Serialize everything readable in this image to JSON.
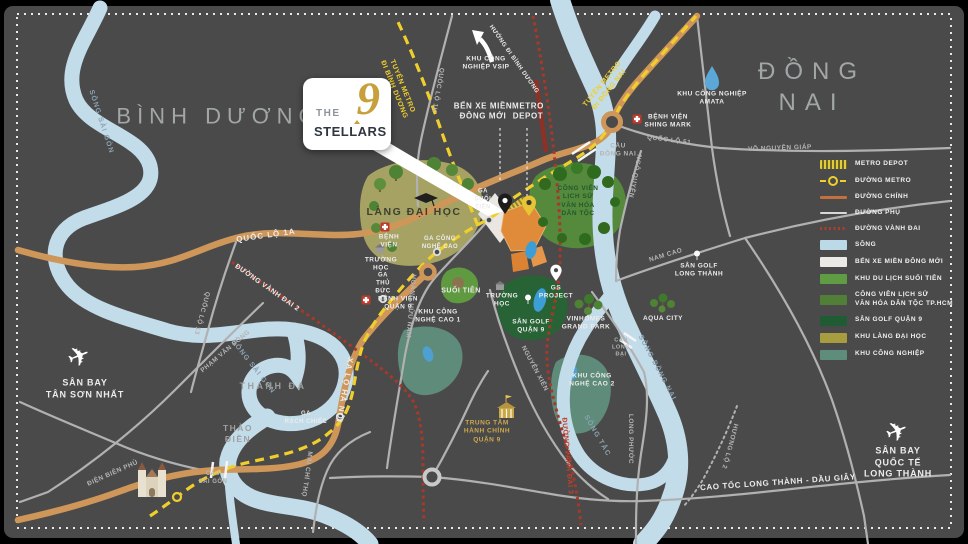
{
  "logo": {
    "the": "THE",
    "nine": "9",
    "name": "STELLARS"
  },
  "colors": {
    "background": "#4a4a4a",
    "river": "#c3dcea",
    "road_main": "#cf9659",
    "road_minor": "#b1b1b1",
    "metro": "#f0cf2c",
    "ring_road": "#a83828",
    "project": "#e08b3a",
    "gold": "#c7a03c"
  },
  "labels": {
    "binh_duong": "BÌNH DƯƠNG",
    "dong_nai": "ĐỒNG NAI",
    "song_sai_gon_a": "SÔNG SÀI GÒN",
    "song_sai_gon_b": "SÔNG SÀI GÒN",
    "song_dong_nai": "SÔNG ĐỒNG NAI",
    "song_tac": "SÔNG TẮC",
    "khu_cn_vsip": "KHU CÔNG\nNGHIỆP VSIP",
    "huong_di_binh_duong": "HƯỚNG ĐI BÌNH DƯƠNG",
    "tuyen_metro_binh_duong": "TUYẾN METRO\nĐI BÌNH DƯƠNG",
    "tuyen_metro_dong_nai": "TUYẾN METRO\nĐI ĐỒNG NAI",
    "quoc_lo_1k": "QUỐC LỘ 1K",
    "ben_xe_mien_dong_moi": "BẾN XE MIỀN\nĐÔNG MỚI",
    "metro_depot_map": "METRO\nDEPOT",
    "cau_dong_nai": "CẦU\nĐỒNG NAI",
    "benh_vien_shing_mark": "BỆNH VIỆN\nSHING MARK",
    "khu_cn_amata": "KHU CÔNG NGHIỆP\nAMATA",
    "quoc_lo_51": "QUỐC LỘ 51",
    "vo_nguyen_giap": "VÕ NGUYÊN GIÁP",
    "ngo_quyen": "NGÔ QUYỀN",
    "nam_cao": "NAM CAO",
    "san_golf_long_thanh": "SÂN GOLF\nLONG THÀNH",
    "aqua_city": "AQUA CITY",
    "cau_long_dai": "CẦU\nLONG\nĐẠI",
    "long_phuoc": "LONG PHƯỚC",
    "huong_lo_2": "HƯƠNG LỘ 2",
    "cao_toc_long_thanh": "CAO TỐC LONG THÀNH - DẦU GIÂY",
    "san_bay_long_thanh": "SÂN BAY QUỐC TẾ\nLONG THÀNH",
    "san_bay_tan_son_nhat": "SÂN BAY\nTÂN SƠN NHẤT",
    "quoc_lo_1a": "QUỐC LỘ 1A",
    "quoc_lo_13": "QUỐC LỘ 13",
    "duong_vanh_dai_2": "ĐƯỜNG VÀNH ĐAI 2",
    "duong_vanh_dai_3": "ĐƯỜNG VÀNH ĐAI 3",
    "pham_van_dong": "PHẠM VĂN ĐỒNG",
    "thanh_da": "THANH ĐA",
    "thao_dien": "THẢO\nĐIỀN",
    "ga_rach_chiec": "GA\nRẠCH CHIẾC",
    "xa_lo_ha_noi": "XA LỘ HÀ NỘI",
    "mai_chi_tho": "MAI CHÍ THỌ",
    "dien_bien_phu": "ĐIỆN BIÊN PHỦ",
    "cau_sai_gon": "CẦU\nSÀI GÒN",
    "ga_thu_duc": "GA\nTHỦ\nĐỨC",
    "benh_vien_quan_9": "BỆNH VIỆN\nQUẬN 9",
    "khu_cong_nghe_cao_1": "KHU CÔNG\nNGHỆ CAO 1",
    "lang_dai_hoc": "LÀNG ĐẠI HỌC",
    "ga_cong_nghe_cao": "GA CÔNG\nNGHỆ CAO",
    "ga_suoi_tien": "GA\nSUỐI\nTIÊN",
    "benh_vien": "BỆNH\nVIỆN",
    "truong_hoc_1": "TRƯỜNG\nHỌC",
    "truong_hoc_2": "TRƯỜNG\nHỌC",
    "suoi_tien": "SUỐI TIÊN",
    "cong_vien_lich_su": "CÔNG VIÊN\nLỊCH SỬ\nVĂN HÓA\nDÂN TỘC",
    "gs_project": "GS\nPROJECT",
    "san_golf_quan_9": "SÂN GOLF\nQUẬN 9",
    "vinhomes_grand_park": "VINHOMES\nGRAND PARK",
    "hoang_huu_nam": "HOÀNG HỮU NAM",
    "nguyen_xien": "NGUYỄN XIỂN",
    "khu_cong_nghe_cao_2": "KHU CÔNG\nNGHỆ CAO 2",
    "trung_tam_hanh_chinh": "TRUNG TÂM\nHÀNH CHÍNH\nQUẬN 9"
  },
  "legend": {
    "items": [
      {
        "label": "METRO DEPOT",
        "type": "metro-depot"
      },
      {
        "label": "ĐƯỜNG METRO",
        "type": "metro-line"
      },
      {
        "label": "ĐƯỜNG CHÍNH",
        "type": "main-road"
      },
      {
        "label": "ĐƯỜNG PHỤ",
        "type": "minor-road"
      },
      {
        "label": "ĐƯỜNG VÀNH ĐAI",
        "type": "ring-road"
      },
      {
        "label": "SÔNG",
        "type": "river"
      },
      {
        "label": "BẾN XE MIỀN ĐÔNG MỚI",
        "type": "bus-station"
      },
      {
        "label": "KHU DU LỊCH SUỐI TIÊN",
        "type": "suoi-tien"
      },
      {
        "label": "CÔNG VIÊN LỊCH SỬ\nVĂN HÓA DÂN TỘC TP.HCM",
        "type": "history-park"
      },
      {
        "label": "SÂN GOLF QUẬN 9",
        "type": "golf"
      },
      {
        "label": "KHU LÀNG ĐẠI HỌC",
        "type": "university"
      },
      {
        "label": "KHU CÔNG NGHIỆP",
        "type": "industrial"
      }
    ]
  }
}
